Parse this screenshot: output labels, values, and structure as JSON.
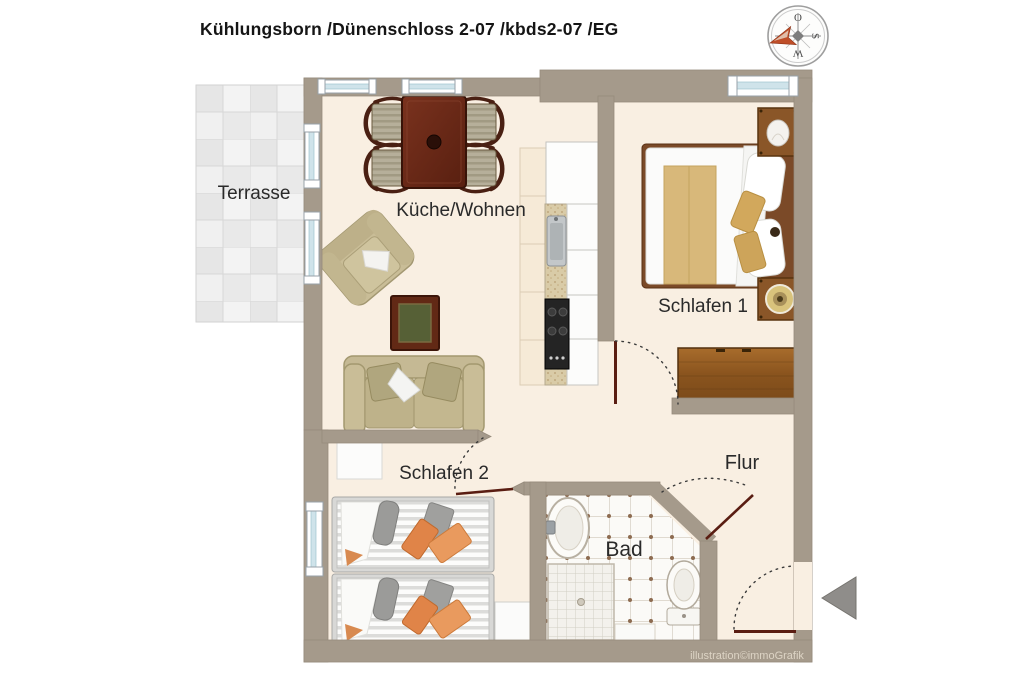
{
  "title": "Kühlungsborn /Dünenschloss 2-07 /kbds2-07 /EG",
  "rooms": {
    "terrasse": {
      "label": "Terrasse"
    },
    "kueche_wohnen": {
      "label": "Küche/Wohnen"
    },
    "schlafen1": {
      "label": "Schlafen 1"
    },
    "schlafen2": {
      "label": "Schlafen 2"
    },
    "flur": {
      "label": "Flur"
    },
    "bad": {
      "label": "Bad"
    }
  },
  "compass": {
    "top_letter": "O",
    "right_letter": "S",
    "bottom_letter": "W"
  },
  "credit": "illustration©immoGrafik",
  "colors": {
    "wall": "#a59a8b",
    "floor": "#f9efe2",
    "terrace_tile": "#ececec",
    "window_glass": "#cfe3ea",
    "door_leaf": "#5a1d12",
    "wood_dark": "#622915",
    "wood_mid": "#8a5628",
    "cushion_orange": "#e08448",
    "entrance_arrow": "#8f8d8a"
  }
}
